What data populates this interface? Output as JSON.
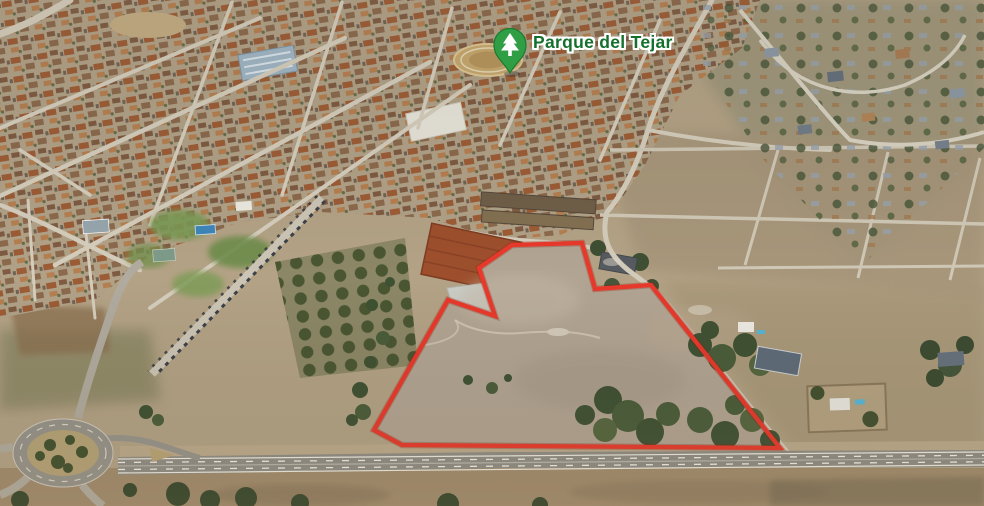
{
  "marker": {
    "label": "Parque del Tejar",
    "icon": "tree-icon",
    "pin_color": "#2f9e44"
  },
  "parcel": {
    "outline_points": "512,245 582,243 595,289 651,285 780,448 402,445 374,430 448,300 495,316 479,268",
    "outline_color": "#e8392b"
  },
  "colors": {
    "terrain_tan": "#b4a489",
    "town_roofs": "#9b5a33",
    "vegetation": "#46532f",
    "road_gray": "#d5cdbc",
    "highway_gray": "#8f8d85"
  }
}
